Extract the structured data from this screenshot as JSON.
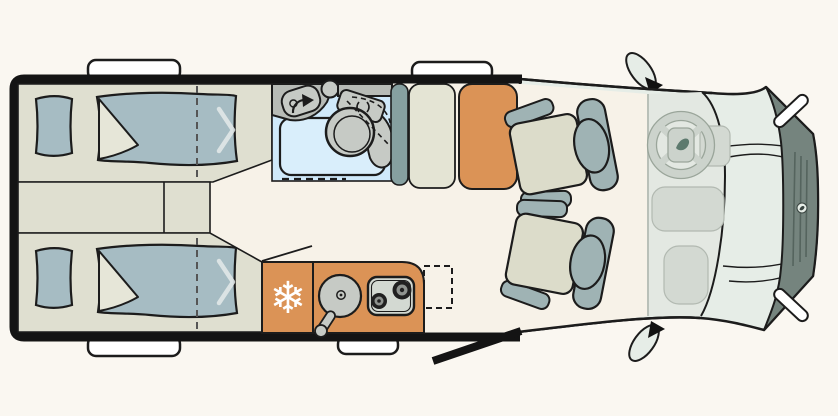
{
  "scene": {
    "type": "motorhome-floorplan-top-view",
    "width": 838,
    "height": 416
  },
  "colors": {
    "background": "#faf7f1",
    "outline": "#1c1c1c",
    "wall": "#141414",
    "floor": "#f7f2e8",
    "bed_base": "#dfdfd0",
    "cabinet_beige": "#e4e4d4",
    "bedding_blue": "#a6bcc3",
    "bedding_fold": "#e6e6d8",
    "bath_floor": "#cfe9fa",
    "shower_tray": "#d9eefb",
    "fixture_gray": "#c6cac5",
    "counter_gray": "#b7bbb6",
    "accent_orange": "#db9356",
    "panel_teal": "#86a0a0",
    "seat_cushion": "#dcdcca",
    "seat_frame": "#9fb3b4",
    "cab_body": "#e6ede7",
    "cab_interior": "#e3e8e2",
    "cab_front": "#75847e",
    "cab_dash": "#d3d9d2",
    "steering_wheel": "#ccd3cc",
    "grille_line": "#55645e",
    "logo_leaf": "#5d7a6e",
    "window_tab": "#ffffff",
    "chevron_white": "#e4eaea",
    "snowflake_white": "#ffffff",
    "dash_line_gray": "#555555",
    "floor_divider_gray": "#b9c0b8"
  },
  "icons": {
    "fridge_snowflake": "❄"
  }
}
